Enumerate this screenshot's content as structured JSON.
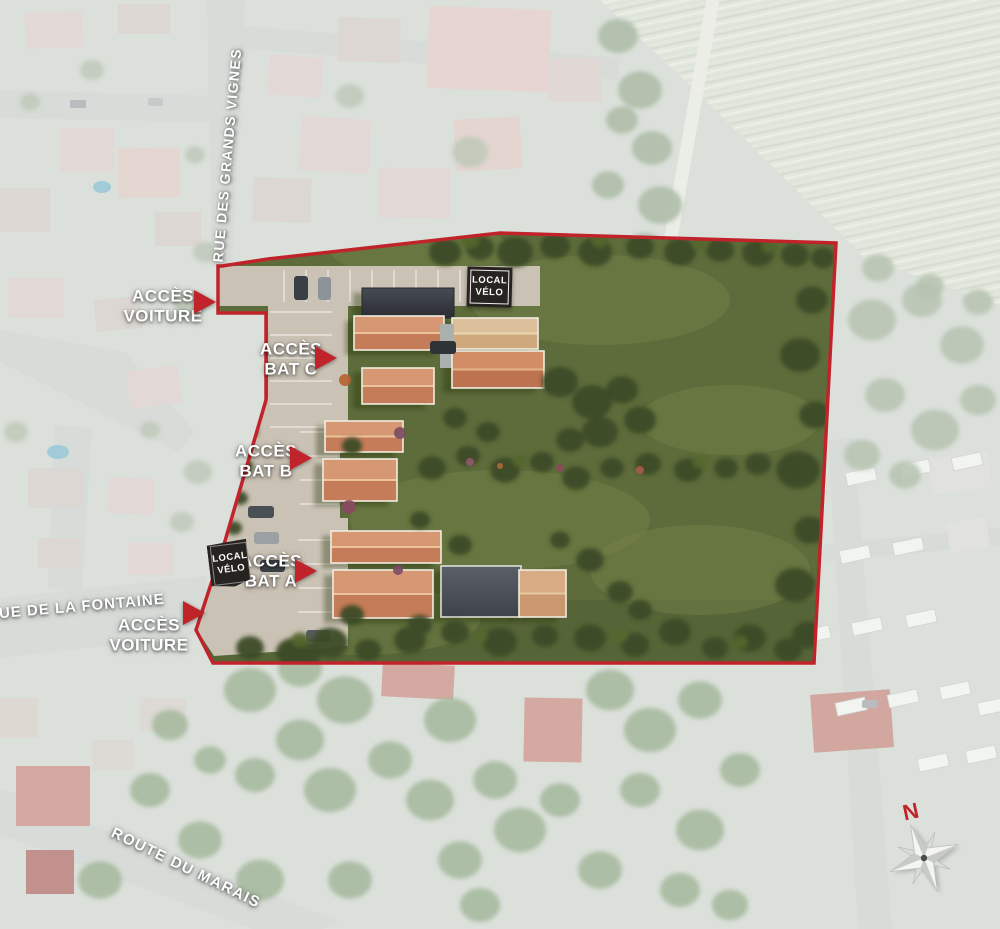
{
  "streets": {
    "grands_vignes": "RUE DES GRANDS VIGNES",
    "fontaine": "RUE DE LA FONTAINE",
    "marais": "ROUTE DU MARAIS"
  },
  "access": {
    "car_top": {
      "line1": "ACCÈS",
      "line2": "VOITURE"
    },
    "bat_c": {
      "line1": "ACCÈS",
      "line2": "BAT C"
    },
    "bat_b": {
      "line1": "ACCÈS",
      "line2": "BAT B"
    },
    "bat_a": {
      "line1": "ACCÈS",
      "line2": "BAT A"
    },
    "car_bottom": {
      "line1": "ACCÈS",
      "line2": "VOITURE"
    }
  },
  "badges": {
    "local_velo_top": {
      "line1": "LOCAL",
      "line2": "VÉLO"
    },
    "local_velo_bottom": {
      "line1": "LOCAL",
      "line2": "VÉLO"
    }
  },
  "compass": {
    "north": "N"
  },
  "colors": {
    "boundary_red": "#c1232b",
    "site_green": "#5e6c3b",
    "badge_dark": "#272320",
    "label_white": "#ffffff",
    "pavement": "#cac2b4",
    "roof_terracotta": "#cd8160",
    "roof_pale": "#d9b995",
    "building_dark": "#35383d"
  }
}
